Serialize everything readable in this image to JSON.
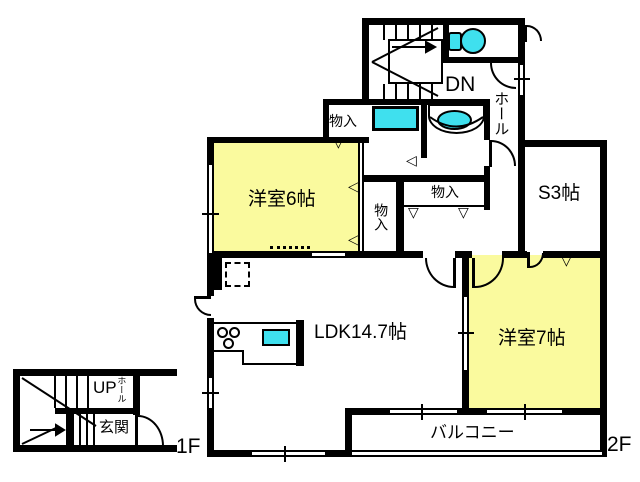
{
  "title": "apartment-floor-plan",
  "floor_labels": {
    "first": "1F",
    "second": "2F"
  },
  "rooms": {
    "western6": "洋室6帖",
    "western7": "洋室7帖",
    "ldk": "LDK14.7帖",
    "service3": "S3帖",
    "balcony": "バルコニー",
    "hall_2f": "ホール",
    "hall_1f": "ホール",
    "entrance": "玄関",
    "closet_top": "物入",
    "closet_mid": "物入",
    "closet_hall": "物入"
  },
  "stairs": {
    "down": "DN",
    "up": "UP"
  },
  "icons": {
    "slide_marker_down": "▽",
    "slide_marker_left": "◁"
  },
  "fixtures": [
    "toilet",
    "bathtub",
    "washbasin",
    "kitchen-sink",
    "gas-stove",
    "refrigerator"
  ],
  "colors": {
    "room_fill": "#FAFA9E",
    "fixture_fill": "#3FE0EE",
    "wall": "#000000",
    "background": "#FFFFFF"
  }
}
